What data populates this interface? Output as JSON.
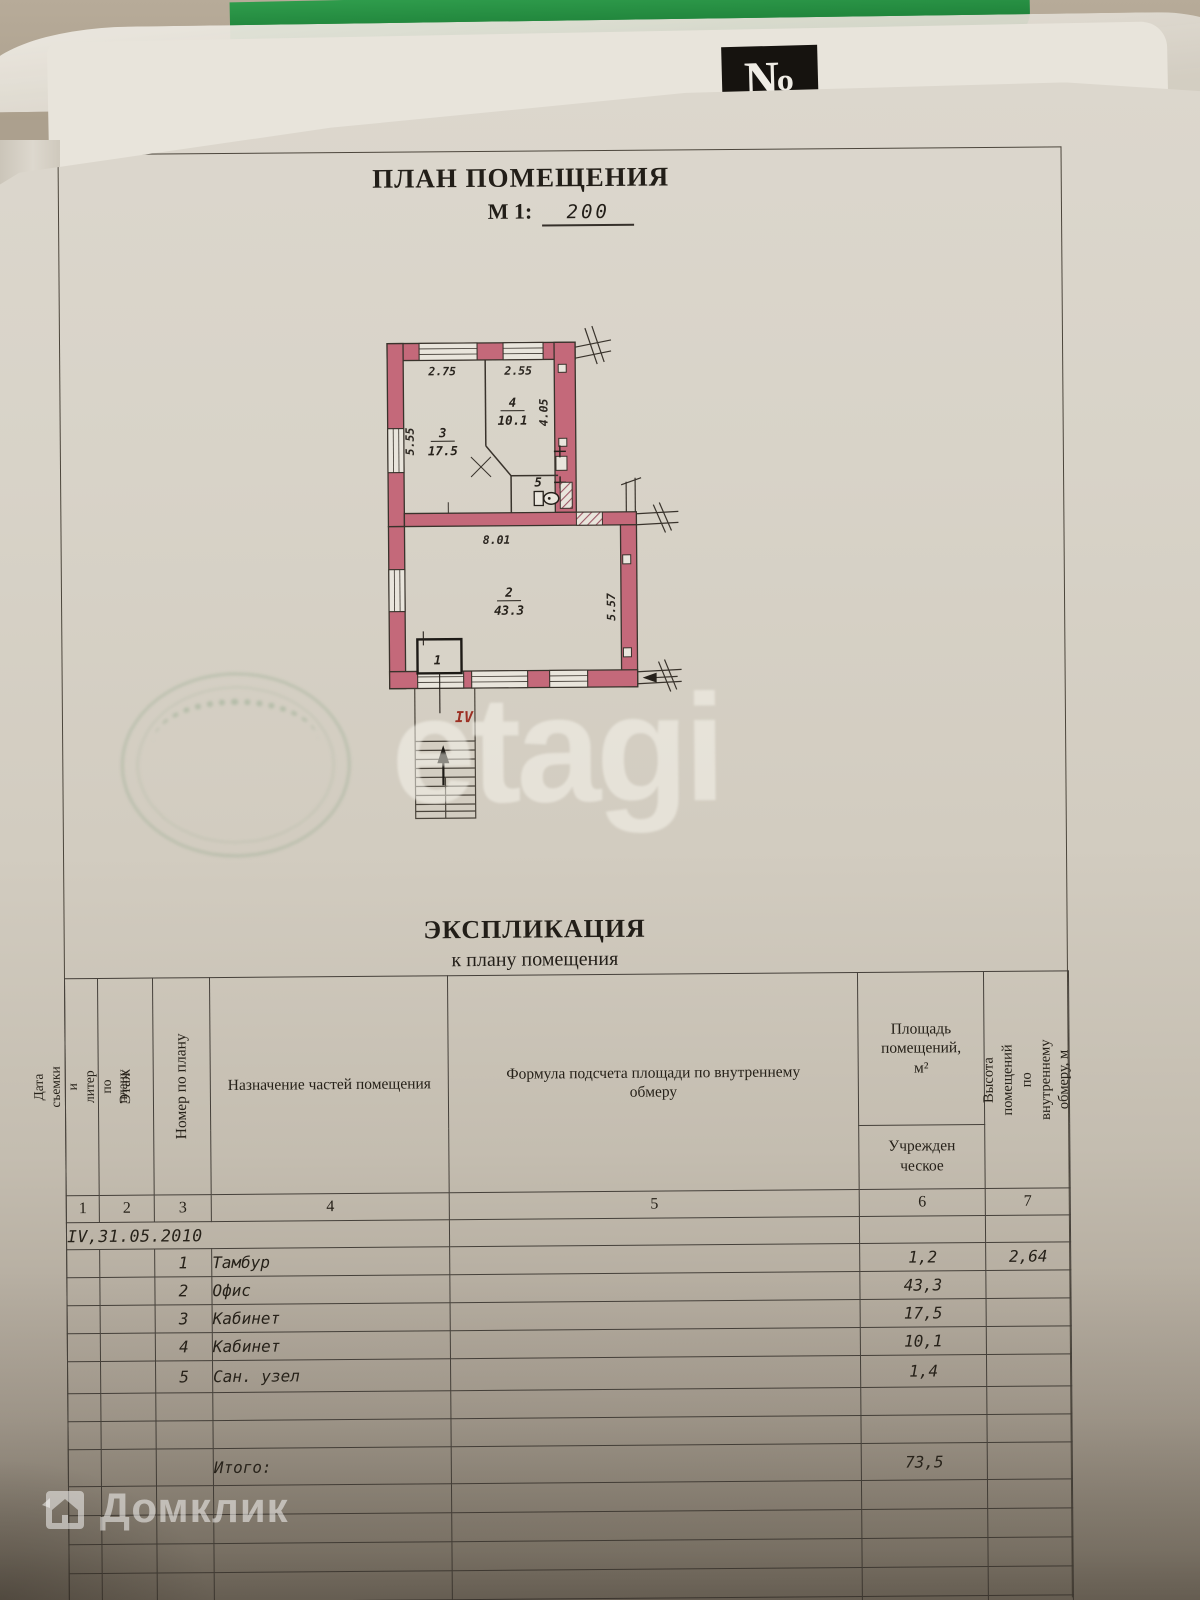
{
  "header": {
    "badge": "№",
    "title": "ПЛАН ПОМЕЩЕНИЯ",
    "scale_label": "М 1:",
    "scale_value": "200"
  },
  "plan": {
    "floor_label": "IV",
    "dims": {
      "top_left": "2.75",
      "top_right": "2.55",
      "left": "5.55",
      "right_top": "4.05",
      "mid": "8.01",
      "right_bottom": "5.57"
    },
    "rooms": {
      "r1_num": "1",
      "r2_num": "2",
      "r2_area": "43.3",
      "r3_num": "3",
      "r3_area": "17.5",
      "r4_num": "4",
      "r4_area": "10.1",
      "r5_num": "5"
    }
  },
  "explication": {
    "title": "ЭКСПЛИКАЦИЯ",
    "subtitle": "к плану помещения",
    "col1a": "Дата съемки и",
    "col1b": "литер по плану",
    "col2": "Этаж",
    "col3": "Номер по плану",
    "col4": "Назначение частей помещения",
    "col5": "Формула подсчета площади по внутреннему обмеру",
    "col6a": "Площадь помещений,",
    "col6b": "м²",
    "col6sub1": "Учрежден",
    "col6sub2": "ческое",
    "col7": "Высота помещений по внутреннему обмеру, м",
    "numbers": [
      "1",
      "2",
      "3",
      "4",
      "5",
      "6",
      "7"
    ],
    "date_row": "IV,31.05.2010",
    "rows": [
      {
        "num": "1",
        "name": "Тамбур",
        "area": "1,2",
        "height": "2,64"
      },
      {
        "num": "2",
        "name": "Офис",
        "area": "43,3",
        "height": ""
      },
      {
        "num": "3",
        "name": "Кабинет",
        "area": "17,5",
        "height": ""
      },
      {
        "num": "4",
        "name": "Кабинет",
        "area": "10,1",
        "height": ""
      },
      {
        "num": "5",
        "name": "Сан. узел",
        "area": "1,4",
        "height": ""
      }
    ],
    "total_label": "Итого:",
    "total_value": "73,5"
  },
  "watermarks": {
    "etagi": "etagi",
    "domclick": "Домклик"
  },
  "colors": {
    "wall_pink": "#c4697a",
    "red_label": "#9c2f23",
    "paper": "#d8d3c8",
    "line": "#45403a",
    "stamp_green": "#5f8c64",
    "folder_green": "#2f9c4c"
  }
}
